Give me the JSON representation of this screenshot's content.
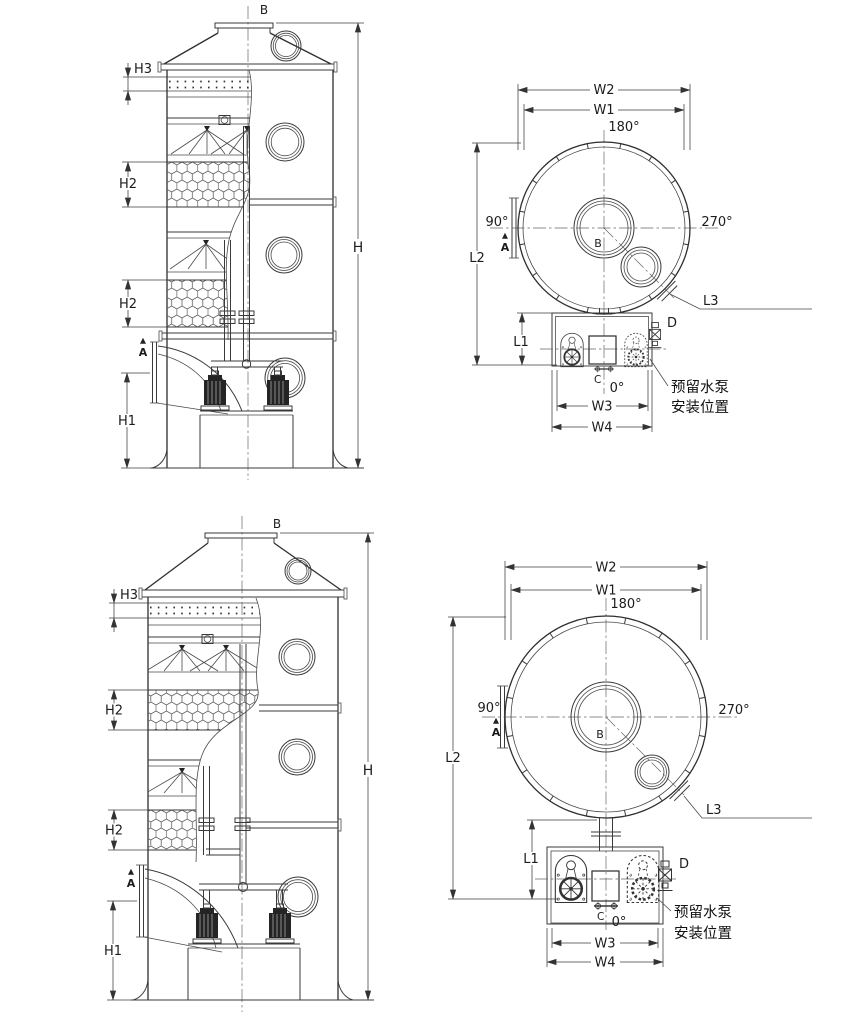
{
  "page": {
    "background": "#ffffff",
    "ink": "#2e2e2e"
  },
  "labels": {
    "h": "H",
    "h1": "H1",
    "h2": "H2",
    "h3": "H3",
    "w1": "W1",
    "w2": "W2",
    "w3": "W3",
    "w4": "W4",
    "l1": "L1",
    "l2": "L2",
    "l3": "L3",
    "a": "A",
    "b": "B",
    "c": "C",
    "d": "D",
    "deg0": "0°",
    "deg90": "90°",
    "deg180": "180°",
    "deg270": "270°"
  },
  "annotations": {
    "pump_note_line1": "预留水泵",
    "pump_note_line2": "安装位置"
  }
}
